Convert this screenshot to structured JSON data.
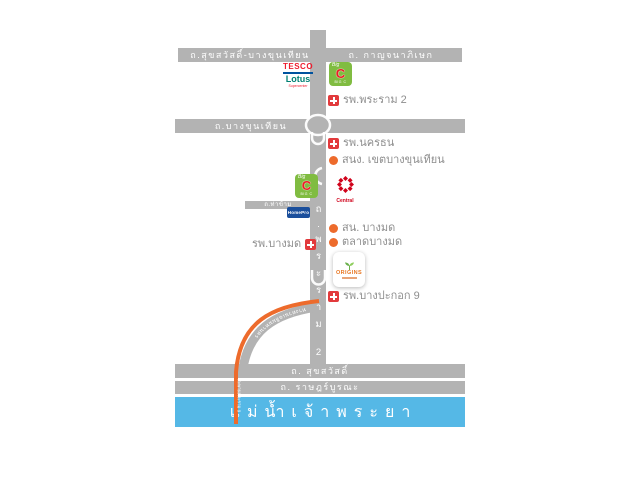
{
  "map": {
    "colors": {
      "road_gray": "#b3b3b3",
      "river_blue": "#55b8e6",
      "accent_orange": "#ed6b2c",
      "hospital_red": "#e23a3c",
      "label_gray": "#8e8e8e"
    },
    "roads": {
      "top_left": "ถ.สุขสวัสดิ์-บางขุนเทียน",
      "top_right": "ถ. กาญจนาภิเษก",
      "bang_khun_thian": "ถ.บางขุนเทียน",
      "tha_kham": "ถ.ท่าข้าม",
      "rama2_vertical": "ถ.พระราม 2",
      "suksawat": "ถ. สุขสวัสดิ์",
      "rat_burana": "ถ. ราษฎร์บูรณะ",
      "expressway_ramp": "ทางด่วนเฉลิมมหานคร",
      "bridge": "สะพานพระราม 9"
    },
    "river_name": "แม่น้ำเจ้าพระยา",
    "landmarks": {
      "rama2_hospital": "รพ.พระราม 2",
      "nakhonthon_hospital": "รพ.นครธน",
      "bangkhunthian_district_office": "สนง. เขตบางขุนเทียน",
      "bangmot_police_station": "สน. บางมด",
      "bangmot_market": "ตลาดบางมด",
      "bangmot_hospital": "รพ.บางมด",
      "bangpakok9_hospital": "รพ.บางปะกอก 9"
    },
    "logos": {
      "tesco_line1": "TESCO",
      "tesco_line2": "Lotus",
      "tesco_tagline": "Supercenter",
      "bigc_big": "Big",
      "bigc_c": "C",
      "bigc_name": "BIG C",
      "central_name": "Central",
      "homepro_name": "HomePro",
      "origins_name": "ORIGINS"
    }
  }
}
